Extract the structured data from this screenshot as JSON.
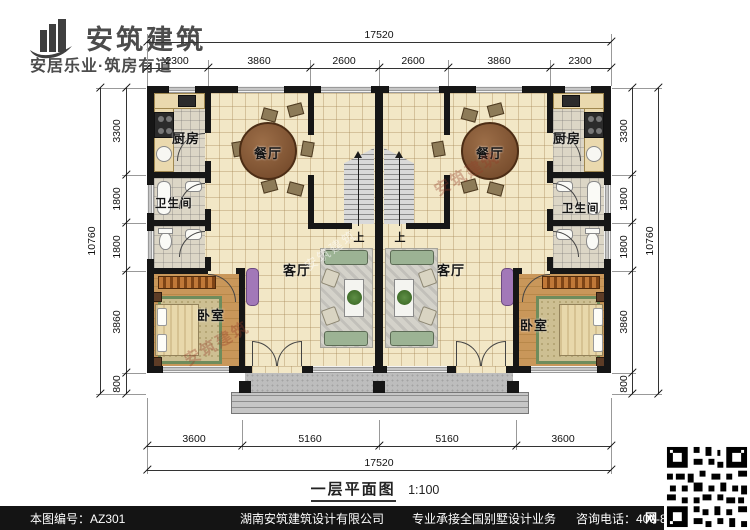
{
  "brand": {
    "title": "安筑建筑",
    "tagline": "安居乐业·筑房有道"
  },
  "dimensions": {
    "top": {
      "total": "17520",
      "segments": [
        "2300",
        "3860",
        "2600",
        "2600",
        "3860",
        "2300"
      ]
    },
    "bottom": {
      "total": "17520",
      "segments": [
        "3600",
        "5160",
        "5160",
        "3600"
      ]
    },
    "left": {
      "total": "10760",
      "segments": [
        "3300",
        "1800",
        "1800",
        "3860",
        "800"
      ]
    },
    "right": {
      "total": "10760",
      "segments": [
        "3300",
        "1800",
        "1800",
        "3860",
        "800"
      ]
    }
  },
  "rooms": {
    "kitchen": "厨房",
    "dining": "餐厅",
    "bathroom": "卫生间",
    "living": "客厅",
    "bedroom": "卧室",
    "stair_up": "上"
  },
  "caption": {
    "title": "一层平面图",
    "scale": "1:100"
  },
  "footer": {
    "code": "本图编号：AZ301",
    "company": "湖南安筑建筑设计有限公司",
    "slogan": "专业承接全国别墅设计业务",
    "phone": "咨询电话：400-8070-511",
    "web": "网"
  },
  "watermark": "安筑建筑",
  "colors": {
    "wall": "#161616",
    "floor": "#f2e7c6",
    "wood": "#c9975a",
    "accent": "#b5703a"
  }
}
